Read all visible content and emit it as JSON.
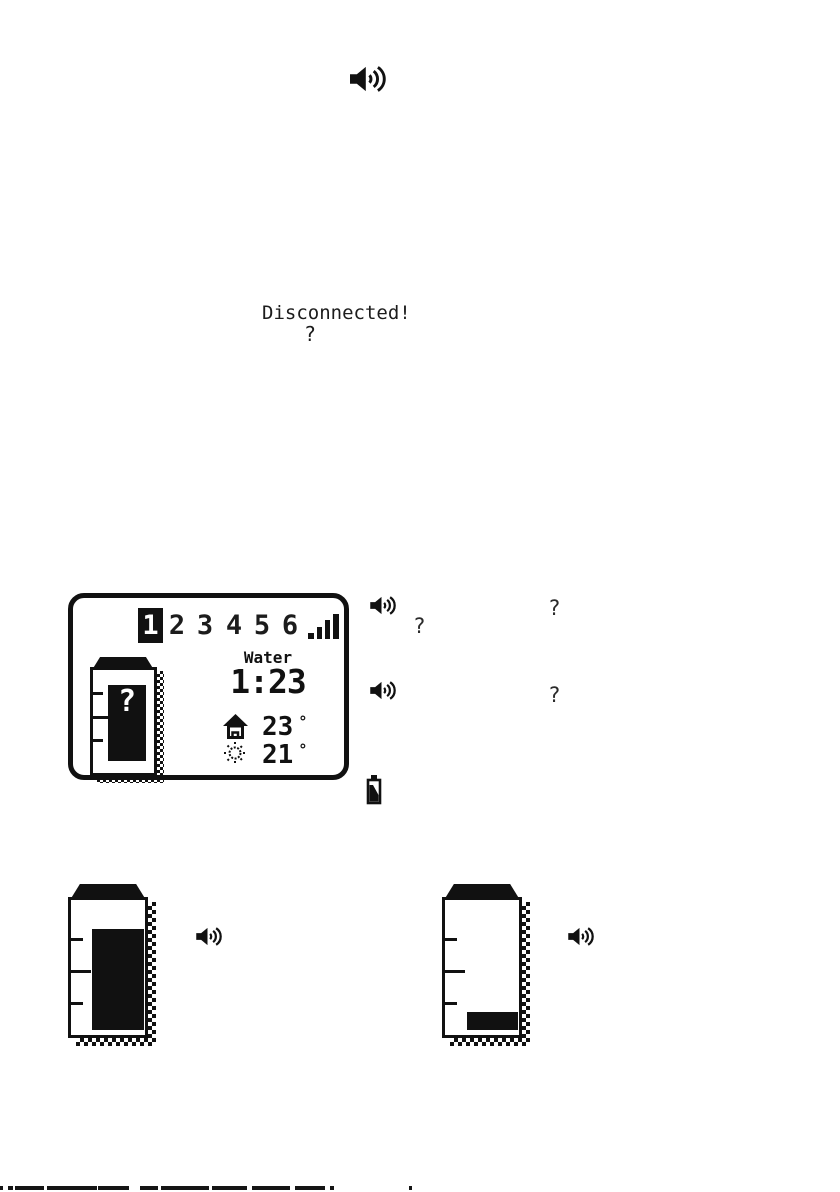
{
  "page": {
    "background": "#ffffff",
    "ink": "#111111"
  },
  "header": {
    "icon": "speaker-icon"
  },
  "status": {
    "message": "Disconnected!",
    "question": "?"
  },
  "lcd_display": {
    "channels": [
      "1",
      "2",
      "3",
      "4",
      "5",
      "6"
    ],
    "selected_index": 0,
    "signal_icon": "signal-strength-icon",
    "sensor_name": "Water",
    "time": "1:23",
    "indoor": {
      "icon": "house-icon",
      "temp": "23",
      "unit": "°"
    },
    "outdoor": {
      "icon": "sun-icon",
      "temp": "21",
      "unit": "°"
    },
    "tank": {
      "question_mark": "?",
      "level": "unknown"
    }
  },
  "annotations": {
    "q1": "?",
    "q2": "?",
    "q3": "?",
    "battery_icon": "battery-low-icon",
    "speaker_icon": "speaker-icon"
  },
  "tank_full": {
    "level": "full",
    "icon": "speaker-icon"
  },
  "tank_low": {
    "level": "low",
    "icon": "speaker-icon"
  }
}
